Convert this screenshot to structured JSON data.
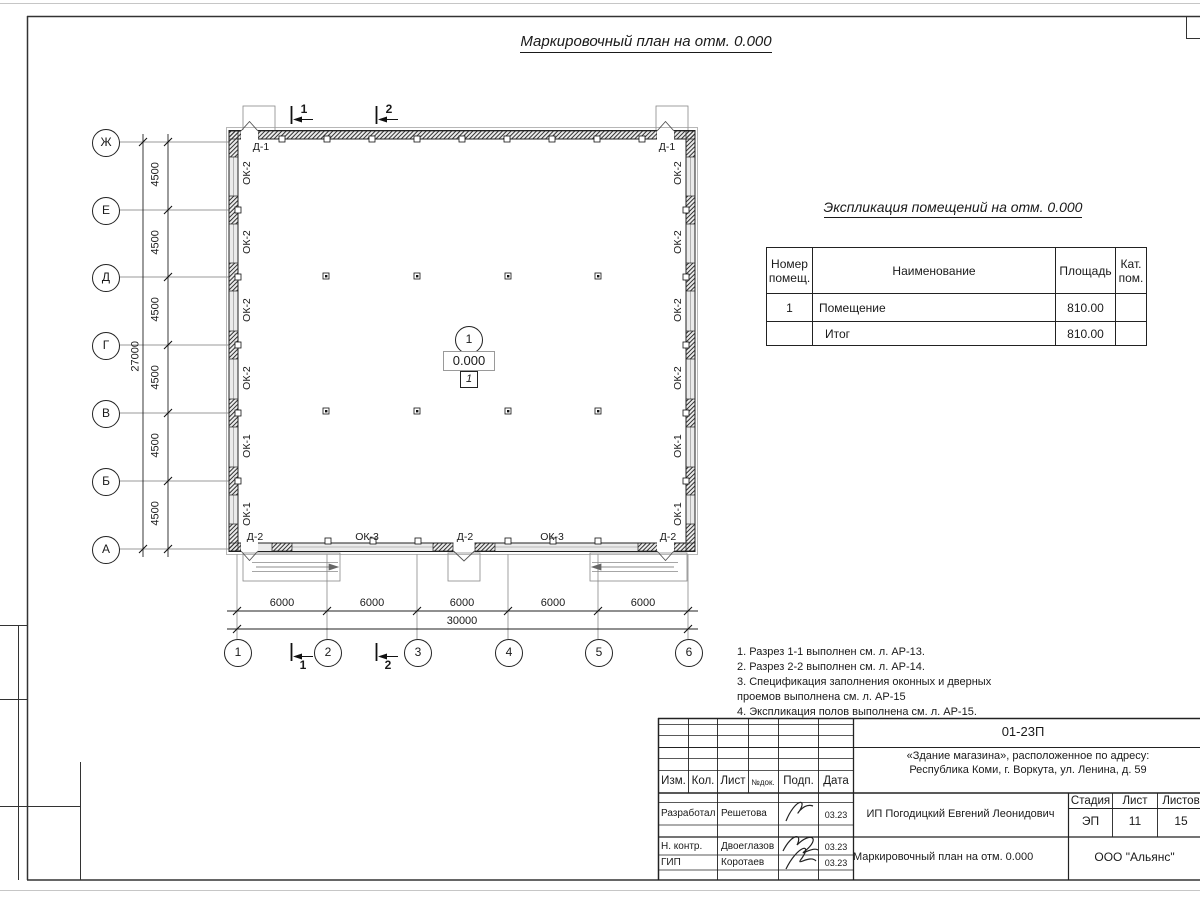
{
  "sheet": {
    "plan_title": "Маркировочный план на отм. 0.000"
  },
  "plan": {
    "axes_left": [
      "Ж",
      "Е",
      "Д",
      "Г",
      "В",
      "Б",
      "А"
    ],
    "axes_bottom": [
      "1",
      "2",
      "3",
      "4",
      "5",
      "6"
    ],
    "dims": {
      "bay_v": "4500",
      "total_v": "27000",
      "bay_h": "6000",
      "total_h": "30000"
    },
    "labels": {
      "ok1": "ОК-1",
      "ok2": "ОК-2",
      "ok3": "ОК-3",
      "d1": "Д-1",
      "d2": "Д-2"
    },
    "sections": {
      "s1": "1",
      "s2": "2"
    },
    "room": {
      "number": "1",
      "elevation": "0.000",
      "floor_type": "1"
    }
  },
  "explication": {
    "title": "Экспликация помещений на отм. 0.000",
    "headers": {
      "number": "Номер помещ.",
      "name": "Наименование",
      "area": "Площадь",
      "cat": "Кат. пом."
    },
    "rows": [
      {
        "number": "1",
        "name": "Помещение",
        "area": "810.00",
        "cat": ""
      },
      {
        "number": "",
        "name": "Итог",
        "area": "810.00",
        "cat": ""
      }
    ]
  },
  "notes": [
    "1. Разрез 1-1 выполнен см. л. АР-13.",
    "2. Разрез 2-2 выполнен см. л. АР-14.",
    "3. Спецификация заполнения оконных и дверных\n    проемов выполнена см. л. АР-15",
    "4. Экспликация полов выполнена см. л. АР-15."
  ],
  "titleblock": {
    "doc_number": "01-23П",
    "project_line1": "«Здание магазина», расположенное по адресу:",
    "project_line2": "Республика Коми, г. Воркута, ул. Ленина, д. 59",
    "client": "ИП Погодицкий Евгений Леонидович",
    "sheet_name": "Маркировочный план на отм. 0.000",
    "company": "ООО \"Альянс\"",
    "cols": {
      "izm": "Изм.",
      "kol": "Кол.",
      "list": "Лист",
      "ndoc": "№док.",
      "podp": "Подп.",
      "data": "Дата"
    },
    "stadia_label": "Стадия",
    "list_label": "Лист",
    "listov_label": "Листов",
    "stadia": "ЭП",
    "list_num": "11",
    "listov": "15",
    "roles": [
      {
        "role": "Разработал",
        "name": "Решетова",
        "date": "03.23"
      },
      {
        "role": "Н. контр.",
        "name": "Двоеглазов",
        "date": "03.23"
      },
      {
        "role": "ГИП",
        "name": "Коротаев",
        "date": "03.23"
      }
    ]
  }
}
